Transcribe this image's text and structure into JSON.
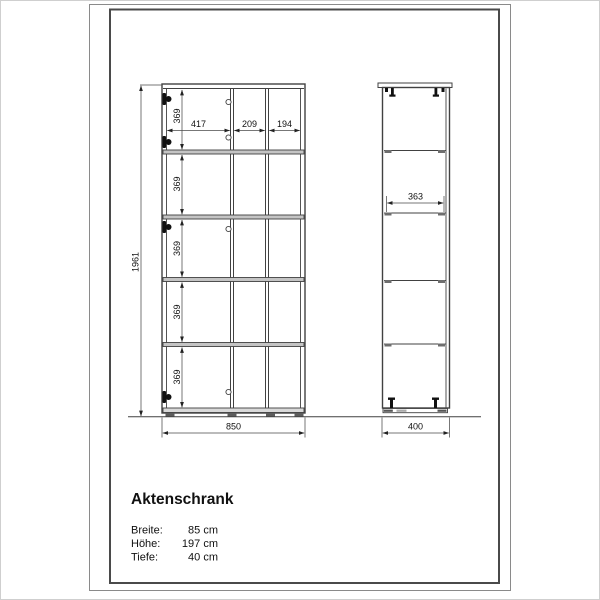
{
  "page": {
    "title": "Aktenschrank",
    "specs": [
      {
        "label": "Breite:",
        "value": "85 cm"
      },
      {
        "label": "Höhe:",
        "value": "197 cm"
      },
      {
        "label": "Tiefe:",
        "value": "40 cm"
      }
    ]
  },
  "drawing": {
    "front_view": {
      "total_height_mm": "1961",
      "total_width_mm": "850",
      "column_widths_mm": [
        "417",
        "209",
        "194"
      ],
      "row_heights_mm": [
        "369",
        "369",
        "369",
        "369",
        "369"
      ]
    },
    "side_view": {
      "total_depth_mm": "400",
      "shelf_depth_mm": "363"
    },
    "colors": {
      "line": "#414141",
      "text": "#111111",
      "frame_outer": "#8a8a8a",
      "frame_inner": "#4a4a4a"
    }
  }
}
